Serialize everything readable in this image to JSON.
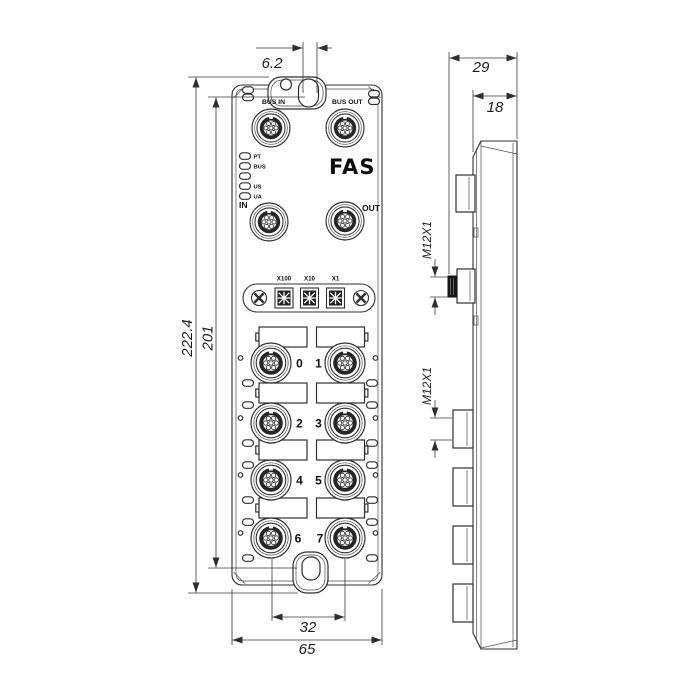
{
  "front": {
    "bus_in": "BUS IN",
    "bus_out": "BUS OUT",
    "in": "IN",
    "out": "OUT",
    "brand": "FAS",
    "leds": [
      "PT",
      "BUS",
      "",
      "US",
      "UA"
    ],
    "switches": [
      "X100",
      "X10",
      "X1"
    ],
    "ports": [
      "0",
      "1",
      "2",
      "3",
      "4",
      "5",
      "6",
      "7"
    ]
  },
  "dims": {
    "slot_width": "6.2",
    "overall_height": "222.4",
    "mount_height": "201",
    "port_span": "32",
    "overall_width": "65",
    "depth": "29",
    "body_depth": "18",
    "thread_top": "M12X1",
    "thread_mid": "M12X1"
  },
  "colors": {
    "line": "#2f2f2f",
    "text": "#1c1c1c",
    "dark_fill": "#1e1e1e",
    "background": "#ffffff"
  }
}
